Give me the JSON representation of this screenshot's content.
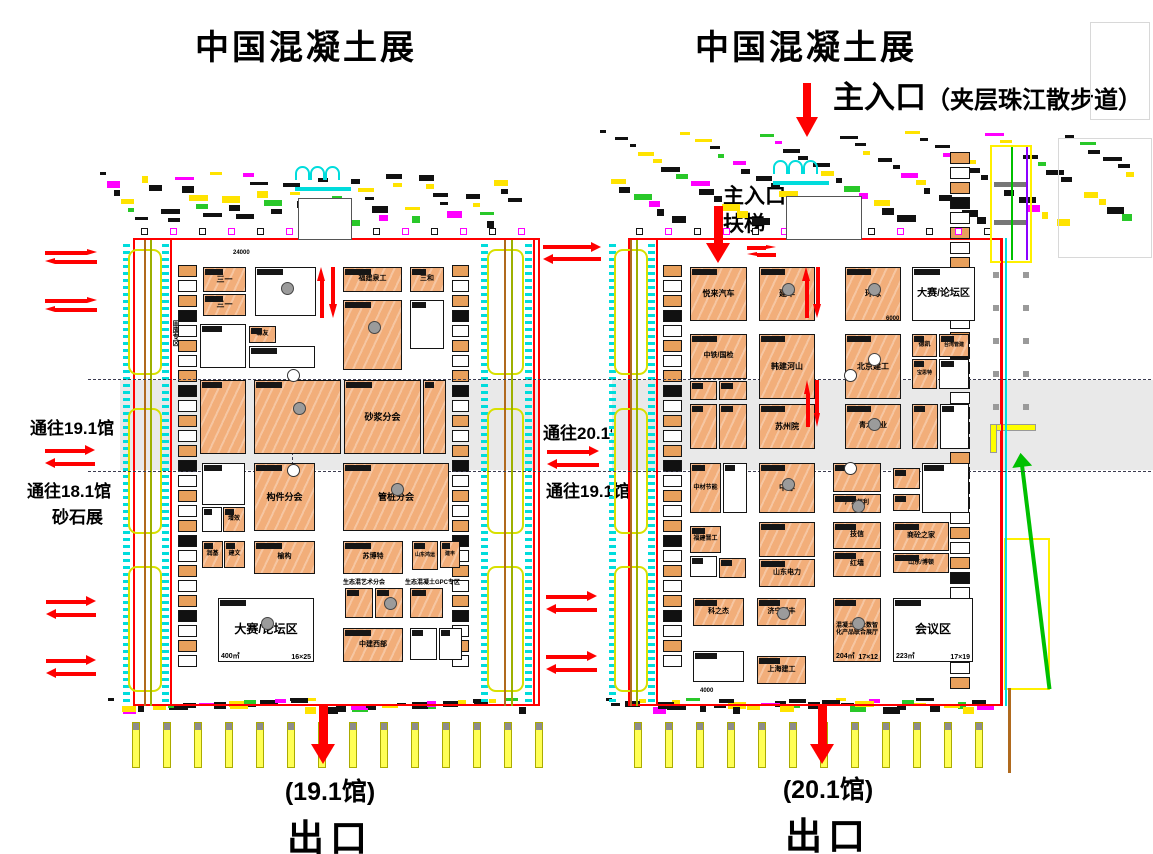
{
  "titles": {
    "left": "中国混凝土展",
    "right": "中国混凝土展"
  },
  "entrance": {
    "main": "主入口",
    "main_note": "（夹层珠江散步道）",
    "inner_line1": "主入口",
    "inner_line2": "扶梯"
  },
  "side_labels": {
    "to_19_1_left": "通往19.1馆",
    "to_18_1": "通往18.1馆",
    "sand_expo": "砂石展",
    "to_20_1": "通往20.1馆",
    "to_19_1_mid": "通往19.1馆",
    "solid_waste_zone": "固废专区"
  },
  "exits": {
    "left_hall": "(19.1馆)",
    "left_exit": "出口",
    "right_hall": "(20.1馆)",
    "right_exit": "出口"
  },
  "captions": [
    {
      "t": "生态混艺术分会",
      "x": 343,
      "y": 577,
      "fs": 6
    },
    {
      "t": "生态混凝土GPC专区",
      "x": 405,
      "y": 577,
      "fs": 6
    },
    {
      "t": "24000",
      "x": 233,
      "y": 250,
      "fs": 6
    },
    {
      "t": "6000",
      "x": 886,
      "y": 316,
      "fs": 6
    },
    {
      "t": "4000",
      "x": 700,
      "y": 688,
      "fs": 6
    }
  ],
  "colors": {
    "booth_orange": "#F2AE7A",
    "wall_red": "#ff0000",
    "arrow_red": "#fe0000",
    "cyan": "#00dcdc",
    "yellow": "#ffff00",
    "magenta": "#ff00ff",
    "olive": "#9db000",
    "brown": "#b06a1e",
    "green": "#00c000",
    "band_gray": "#e9e9e9"
  },
  "halls": [
    {
      "id": "19.1馆",
      "booths": [
        {
          "x": 203,
          "y": 267,
          "w": 43,
          "h": 25,
          "f": "o",
          "l": "三一",
          "fs": 8
        },
        {
          "x": 203,
          "y": 294,
          "w": 43,
          "h": 22,
          "f": "o",
          "l": "三一",
          "fs": 8
        },
        {
          "x": 255,
          "y": 267,
          "w": 61,
          "h": 49,
          "f": "w",
          "dot": "g"
        },
        {
          "x": 343,
          "y": 267,
          "w": 59,
          "h": 25,
          "f": "o",
          "l": "福建泉工",
          "fs": 7
        },
        {
          "x": 410,
          "y": 267,
          "w": 34,
          "h": 25,
          "f": "o",
          "l": "三和",
          "fs": 7
        },
        {
          "x": 200,
          "y": 324,
          "w": 46,
          "h": 44,
          "f": "w"
        },
        {
          "x": 249,
          "y": 326,
          "w": 27,
          "h": 17,
          "f": "o",
          "l": "森友",
          "fs": 6
        },
        {
          "x": 249,
          "y": 346,
          "w": 66,
          "h": 22,
          "f": "w"
        },
        {
          "x": 343,
          "y": 300,
          "w": 59,
          "h": 70,
          "f": "o",
          "dot": "g"
        },
        {
          "x": 410,
          "y": 300,
          "w": 34,
          "h": 49,
          "f": "w"
        },
        {
          "x": 200,
          "y": 380,
          "w": 46,
          "h": 74,
          "f": "o"
        },
        {
          "x": 254,
          "y": 380,
          "w": 87,
          "h": 74,
          "f": "o",
          "dot": "g"
        },
        {
          "x": 344,
          "y": 380,
          "w": 77,
          "h": 74,
          "f": "o",
          "l": "砂浆分会",
          "fs": 9
        },
        {
          "x": 423,
          "y": 380,
          "w": 23,
          "h": 74,
          "f": "o"
        },
        {
          "x": 202,
          "y": 463,
          "w": 43,
          "h": 42,
          "f": "w"
        },
        {
          "x": 202,
          "y": 507,
          "w": 20,
          "h": 25,
          "f": "w"
        },
        {
          "x": 223,
          "y": 507,
          "w": 22,
          "h": 25,
          "f": "o",
          "l": "增效",
          "fs": 6
        },
        {
          "x": 254,
          "y": 463,
          "w": 61,
          "h": 68,
          "f": "o",
          "l": "构件分会",
          "fs": 9
        },
        {
          "x": 343,
          "y": 463,
          "w": 106,
          "h": 68,
          "f": "o",
          "l": "管桩分会",
          "fs": 9,
          "dot": "g"
        },
        {
          "x": 202,
          "y": 541,
          "w": 21,
          "h": 27,
          "f": "o",
          "l": "润基",
          "fs": 6
        },
        {
          "x": 224,
          "y": 541,
          "w": 21,
          "h": 27,
          "f": "o",
          "l": "建文",
          "fs": 6
        },
        {
          "x": 254,
          "y": 541,
          "w": 61,
          "h": 33,
          "f": "o",
          "l": "榆构",
          "fs": 7
        },
        {
          "x": 343,
          "y": 541,
          "w": 60,
          "h": 33,
          "f": "o",
          "l": "苏博特",
          "fs": 7
        },
        {
          "x": 412,
          "y": 541,
          "w": 26,
          "h": 29,
          "f": "o",
          "l": "山东鸿运",
          "fs": 5
        },
        {
          "x": 440,
          "y": 541,
          "w": 20,
          "h": 27,
          "f": "o",
          "l": "建丰",
          "fs": 5
        },
        {
          "x": 345,
          "y": 588,
          "w": 28,
          "h": 30,
          "f": "o"
        },
        {
          "x": 375,
          "y": 588,
          "w": 28,
          "h": 30,
          "f": "o",
          "dot": "g"
        },
        {
          "x": 410,
          "y": 588,
          "w": 33,
          "h": 30,
          "f": "o"
        },
        {
          "x": 218,
          "y": 598,
          "w": 96,
          "h": 64,
          "f": "w",
          "l": "大赛/论坛区",
          "fs": 12,
          "a": "400㎡",
          "d": "16×25",
          "dot": "g"
        },
        {
          "x": 343,
          "y": 628,
          "w": 60,
          "h": 34,
          "f": "o",
          "l": "中建西部",
          "fs": 7
        },
        {
          "x": 410,
          "y": 628,
          "w": 27,
          "h": 32,
          "f": "w"
        },
        {
          "x": 439,
          "y": 628,
          "w": 23,
          "h": 32,
          "f": "w"
        }
      ]
    },
    {
      "id": "20.1馆",
      "booths": [
        {
          "x": 690,
          "y": 267,
          "w": 57,
          "h": 54,
          "f": "o",
          "l": "悦来汽车",
          "fs": 8
        },
        {
          "x": 759,
          "y": 267,
          "w": 56,
          "h": 54,
          "f": "o",
          "l": "建华",
          "fs": 8,
          "dot": "g"
        },
        {
          "x": 845,
          "y": 267,
          "w": 56,
          "h": 54,
          "f": "o",
          "l": "环球",
          "fs": 8,
          "dot": "g"
        },
        {
          "x": 912,
          "y": 267,
          "w": 63,
          "h": 54,
          "f": "w",
          "l": "大赛/论坛区",
          "fs": 10
        },
        {
          "x": 690,
          "y": 334,
          "w": 57,
          "h": 45,
          "f": "o",
          "l": "中铁/国检",
          "fs": 7
        },
        {
          "x": 690,
          "y": 381,
          "w": 27,
          "h": 19,
          "f": "o"
        },
        {
          "x": 719,
          "y": 381,
          "w": 28,
          "h": 19,
          "f": "o"
        },
        {
          "x": 759,
          "y": 334,
          "w": 56,
          "h": 65,
          "f": "o",
          "l": "韩建河山",
          "fs": 8
        },
        {
          "x": 845,
          "y": 334,
          "w": 56,
          "h": 65,
          "f": "o",
          "l": "北京建工",
          "fs": 8,
          "dot": "w"
        },
        {
          "x": 912,
          "y": 334,
          "w": 25,
          "h": 23,
          "f": "o",
          "l": "德凯",
          "fs": 6
        },
        {
          "x": 939,
          "y": 334,
          "w": 30,
          "h": 23,
          "f": "o",
          "l": "台湾管建",
          "fs": 5
        },
        {
          "x": 912,
          "y": 359,
          "w": 25,
          "h": 30,
          "f": "o",
          "l": "宝思特",
          "fs": 5
        },
        {
          "x": 939,
          "y": 359,
          "w": 30,
          "h": 30,
          "f": "w"
        },
        {
          "x": 690,
          "y": 404,
          "w": 27,
          "h": 45,
          "f": "o"
        },
        {
          "x": 719,
          "y": 404,
          "w": 28,
          "h": 45,
          "f": "o"
        },
        {
          "x": 759,
          "y": 404,
          "w": 56,
          "h": 45,
          "f": "o",
          "l": "苏州院",
          "fs": 8
        },
        {
          "x": 845,
          "y": 404,
          "w": 56,
          "h": 45,
          "f": "o",
          "l": "青龙管业",
          "fs": 7,
          "dot": "g"
        },
        {
          "x": 912,
          "y": 404,
          "w": 26,
          "h": 45,
          "f": "o"
        },
        {
          "x": 940,
          "y": 404,
          "w": 29,
          "h": 45,
          "f": "w"
        },
        {
          "x": 690,
          "y": 463,
          "w": 31,
          "h": 50,
          "f": "o",
          "l": "中材节能",
          "fs": 6
        },
        {
          "x": 723,
          "y": 463,
          "w": 24,
          "h": 50,
          "f": "w"
        },
        {
          "x": 759,
          "y": 463,
          "w": 56,
          "h": 50,
          "f": "o",
          "l": "中淳",
          "fs": 8,
          "dot": "g"
        },
        {
          "x": 833,
          "y": 463,
          "w": 48,
          "h": 29,
          "f": "o"
        },
        {
          "x": 833,
          "y": 494,
          "w": 48,
          "h": 19,
          "f": "o",
          "l": "广东恒利",
          "fs": 6,
          "dot": "g"
        },
        {
          "x": 893,
          "y": 468,
          "w": 27,
          "h": 21,
          "f": "o"
        },
        {
          "x": 893,
          "y": 494,
          "w": 27,
          "h": 17,
          "f": "o"
        },
        {
          "x": 922,
          "y": 463,
          "w": 47,
          "h": 50,
          "f": "w"
        },
        {
          "x": 690,
          "y": 526,
          "w": 31,
          "h": 27,
          "f": "o",
          "l": "福建晋工",
          "fs": 6
        },
        {
          "x": 690,
          "y": 556,
          "w": 27,
          "h": 21,
          "f": "w"
        },
        {
          "x": 719,
          "y": 558,
          "w": 27,
          "h": 20,
          "f": "o"
        },
        {
          "x": 759,
          "y": 522,
          "w": 56,
          "h": 35,
          "f": "o"
        },
        {
          "x": 759,
          "y": 559,
          "w": 56,
          "h": 28,
          "f": "o",
          "l": "山东电力",
          "fs": 7
        },
        {
          "x": 833,
          "y": 522,
          "w": 48,
          "h": 27,
          "f": "o",
          "l": "技信",
          "fs": 7
        },
        {
          "x": 833,
          "y": 551,
          "w": 48,
          "h": 26,
          "f": "o",
          "l": "红墙",
          "fs": 7
        },
        {
          "x": 893,
          "y": 522,
          "w": 56,
          "h": 29,
          "f": "o",
          "l": "商砼之家",
          "fs": 7
        },
        {
          "x": 893,
          "y": 553,
          "w": 56,
          "h": 20,
          "f": "o",
          "l": "山东/博顿",
          "fs": 6
        },
        {
          "x": 693,
          "y": 598,
          "w": 51,
          "h": 28,
          "f": "o",
          "l": "科之杰",
          "fs": 7
        },
        {
          "x": 757,
          "y": 598,
          "w": 49,
          "h": 28,
          "f": "o",
          "l": "济宁聚丰",
          "fs": 7,
          "dot": "g"
        },
        {
          "x": 833,
          "y": 598,
          "w": 48,
          "h": 64,
          "f": "o",
          "l": "混凝土行业数智化产品联合展厅",
          "fs": 6,
          "a": "204㎡",
          "d": "17×12",
          "dot": "g"
        },
        {
          "x": 893,
          "y": 598,
          "w": 80,
          "h": 64,
          "f": "w",
          "l": "会议区",
          "fs": 12,
          "a": "223㎡",
          "d": "17×19"
        },
        {
          "x": 693,
          "y": 651,
          "w": 51,
          "h": 31,
          "f": "w"
        },
        {
          "x": 757,
          "y": 656,
          "w": 49,
          "h": 28,
          "f": "o",
          "l": "上海建工",
          "fs": 7
        }
      ]
    }
  ],
  "arrows": [
    {
      "t": "hd",
      "x": 45,
      "y": 249,
      "w": 52,
      "h": 17
    },
    {
      "t": "hd",
      "x": 45,
      "y": 297,
      "w": 52,
      "h": 17
    },
    {
      "t": "hd",
      "x": 45,
      "y": 445,
      "w": 50,
      "h": 24
    },
    {
      "t": "hd",
      "x": 46,
      "y": 596,
      "w": 50,
      "h": 25
    },
    {
      "t": "hd",
      "x": 46,
      "y": 655,
      "w": 50,
      "h": 25
    },
    {
      "t": "hd",
      "x": 543,
      "y": 242,
      "w": 58,
      "h": 23
    },
    {
      "t": "hd",
      "x": 547,
      "y": 446,
      "w": 52,
      "h": 24
    },
    {
      "t": "hd",
      "x": 546,
      "y": 591,
      "w": 51,
      "h": 24
    },
    {
      "t": "hd",
      "x": 546,
      "y": 651,
      "w": 51,
      "h": 24
    },
    {
      "t": "hd",
      "x": 747,
      "y": 245,
      "w": 29,
      "h": 13
    },
    {
      "t": "dn",
      "x": 796,
      "y": 83,
      "w": 22,
      "h": 54
    },
    {
      "t": "dn",
      "x": 706,
      "y": 206,
      "w": 25,
      "h": 57
    },
    {
      "t": "dn",
      "x": 311,
      "y": 706,
      "w": 25,
      "h": 58
    },
    {
      "t": "dn",
      "x": 810,
      "y": 706,
      "w": 25,
      "h": 58
    },
    {
      "t": "vd",
      "x": 317,
      "y": 267,
      "w": 21,
      "h": 51
    },
    {
      "t": "vd",
      "x": 802,
      "y": 267,
      "w": 20,
      "h": 51
    },
    {
      "t": "vd",
      "x": 804,
      "y": 380,
      "w": 17,
      "h": 47
    }
  ],
  "geometry": {
    "bands": [
      {
        "x": 120,
        "y": 380,
        "w": 420,
        "h": 90
      },
      {
        "x": 612,
        "y": 380,
        "w": 541,
        "h": 90
      }
    ],
    "walls": [
      {
        "x": 133,
        "y": 238,
        "w": 407,
        "h": 468
      },
      {
        "x": 628,
        "y": 238,
        "w": 374,
        "h": 468
      }
    ],
    "dash_h": [
      {
        "x": 88,
        "y": 379,
        "w": 1063
      },
      {
        "x": 88,
        "y": 471,
        "w": 1063
      }
    ],
    "dash_v": [
      {
        "x": 292,
        "y": 377,
        "h": 98
      }
    ],
    "white_circles": [
      {
        "x": 287,
        "y": 369
      },
      {
        "x": 287,
        "y": 464
      },
      {
        "x": 844,
        "y": 369
      },
      {
        "x": 844,
        "y": 462
      }
    ],
    "strips": [
      {
        "x": 178,
        "y": 265,
        "w": 19,
        "h": 415
      },
      {
        "x": 452,
        "y": 265,
        "w": 17,
        "h": 410
      },
      {
        "x": 663,
        "y": 265,
        "w": 19,
        "h": 415
      },
      {
        "x": 950,
        "y": 152,
        "w": 20,
        "h": 538
      }
    ],
    "corridors": [
      {
        "x": 120,
        "y": 240,
        "w": 52,
        "h": 466
      },
      {
        "x": 478,
        "y": 240,
        "w": 57,
        "h": 466
      },
      {
        "x": 606,
        "y": 240,
        "w": 52,
        "h": 466
      }
    ],
    "facades": [
      {
        "x": 100,
        "y": 172,
        "w": 438,
        "h": 58,
        "n": 54
      },
      {
        "x": 600,
        "y": 130,
        "w": 548,
        "h": 100,
        "n": 84
      },
      {
        "x": 108,
        "y": 698,
        "w": 430,
        "h": 18,
        "n": 40
      },
      {
        "x": 606,
        "y": 698,
        "w": 398,
        "h": 18,
        "n": 38
      }
    ],
    "square_rows": [
      {
        "x0": 141,
        "y": 228,
        "n": 14,
        "step": 29
      },
      {
        "x0": 636,
        "y": 228,
        "n": 13,
        "step": 29
      }
    ],
    "column_rows": [
      {
        "x0": 132,
        "y": 722,
        "n": 14,
        "step": 31
      },
      {
        "x0": 634,
        "y": 722,
        "n": 12,
        "step": 31
      }
    ],
    "lobbies": [
      {
        "x": 298,
        "y": 198,
        "w": 52,
        "h": 40
      },
      {
        "x": 786,
        "y": 196,
        "w": 74,
        "h": 42
      }
    ],
    "arches": [
      {
        "x": 295,
        "y": 166
      },
      {
        "x": 773,
        "y": 160
      }
    ],
    "ghosts": [
      {
        "x": 1090,
        "y": 22,
        "w": 58,
        "h": 96
      },
      {
        "x": 1058,
        "y": 138,
        "w": 92,
        "h": 118
      }
    ],
    "yframe": {
      "x": 990,
      "y": 145,
      "w": 42,
      "h": 118
    },
    "ytall": {
      "x": 1004,
      "y": 538,
      "w": 46,
      "h": 152
    },
    "ypath": [
      {
        "x": 990,
        "y": 424,
        "w": 44,
        "h": 5
      },
      {
        "x": 990,
        "y": 424,
        "w": 5,
        "h": 27
      }
    ],
    "gdots": [
      {
        "x": 993,
        "y": 272
      },
      {
        "x": 1023,
        "y": 272
      },
      {
        "x": 993,
        "y": 305
      },
      {
        "x": 1023,
        "y": 305
      },
      {
        "x": 993,
        "y": 338
      },
      {
        "x": 1023,
        "y": 338
      },
      {
        "x": 993,
        "y": 371
      },
      {
        "x": 1023,
        "y": 371
      },
      {
        "x": 993,
        "y": 404
      },
      {
        "x": 1023,
        "y": 404
      }
    ],
    "vlines": [
      {
        "x": 1001,
        "y": 238,
        "h": 468,
        "w": 2,
        "c": "#ff0000"
      },
      {
        "x": 1005,
        "y": 238,
        "h": 468,
        "w": 2,
        "c": "#00dcdc"
      },
      {
        "x": 1008,
        "y": 688,
        "h": 85,
        "w": 3,
        "c": "#b06a1e"
      }
    ],
    "green_arrow": {
      "x": 1022,
      "y": 452,
      "h": 238
    }
  }
}
